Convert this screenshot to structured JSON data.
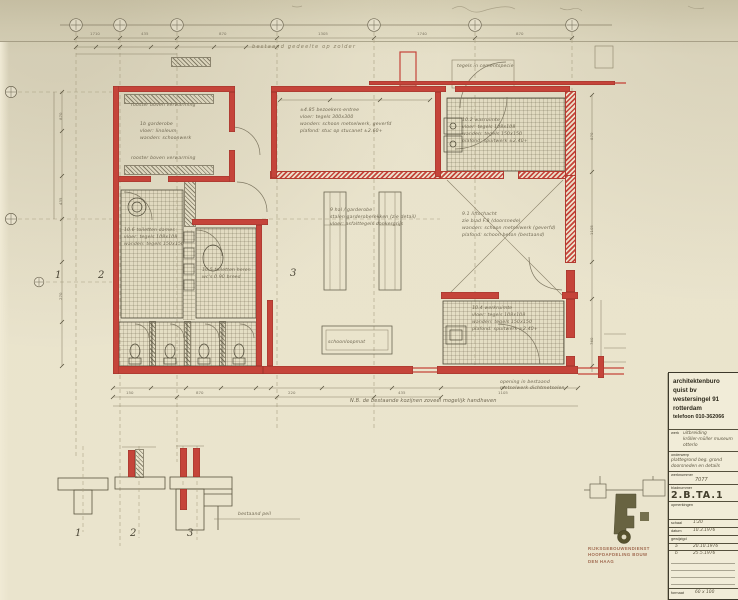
{
  "sheet": {
    "header_note": "bestaand gedeelte op zolder",
    "nb_note": "N.B.  de bestaande kozijnen zoveel mogelijk handhaven",
    "bestaand_peil": "bestaand peil",
    "vestibule_note": "tegels in cementspecie",
    "opening_note_1": "opening in bestaand",
    "opening_note_2": "metselwerk dichtmetselen",
    "section_markers": {
      "s1": "1",
      "s2": "2",
      "s3": "3"
    },
    "detail_labels": {
      "d1": "1",
      "d2": "2",
      "d3": "3"
    }
  },
  "rooms": {
    "garderobe": {
      "strip_top": "rooster boven verwarming",
      "l1": "1b  garderobe",
      "l2": "vloer: linoleum",
      "l3": "wanden: schoonwerk",
      "strip_bottom": "rooster boven verwarming"
    },
    "hal": {
      "l1": "±4.85  bezoekers-entree",
      "l2": "vloer: tegels 300x300",
      "l3": "wanden: schoon metselwerk, geverfd",
      "l4": "plafond: stuc op stucanet  ±2.60+"
    },
    "wasruimte": {
      "l1": "10.2  wasruimte",
      "l2": "vloer: tegels 108x108",
      "l3": "wanden: tegels 150x150",
      "l4": "plafond: spuitwerk  ±2.40+"
    },
    "lift": {
      "l1": "9.1  liftschacht",
      "l2": "zie blad F.8 (doorsnede)",
      "l3": "wanden: schoon metselwerk (geverfd)",
      "l4": "plafond: schoon beton (bestaand)"
    },
    "garderobe_rekken": {
      "l1": "9  hal / garderobe",
      "l2": "stalen garderoberekken (zie detail)",
      "l3": "vloer: asfalttegels donkergrijs"
    },
    "werkkast": {
      "l1": "10.4  werkruimte",
      "l2": "vloer: tegels 108x108",
      "l3": "wanden: tegels 150x150",
      "l4": "plafond: spuitwerk  ±2.40+"
    },
    "dames": {
      "l1": "10.6  toiletten dames",
      "l2": "vloer: tegels 108x108",
      "l3": "wanden: tegels 150x150"
    },
    "heren": {
      "l1": "10.5  toiletten heren",
      "l2": "wc's 0.90 breed"
    },
    "mat": "schoonloopmat"
  },
  "dims": {
    "top": {
      "t1": "1710",
      "t2": "435",
      "t3": "870",
      "t4": "1305",
      "t5": "1740",
      "t6": "870"
    },
    "left": {
      "v1": "870",
      "v2": "435",
      "v3": "270"
    },
    "right": {
      "r1": "870",
      "r2": "1105",
      "r3": "760"
    },
    "bottom": {
      "b1": "150",
      "b2": "870",
      "b3": "220",
      "b4": "435",
      "b5": "1105"
    }
  },
  "title_block": {
    "firm_l1": "architektenburo",
    "firm_l2": "quist bv",
    "firm_l3": "westersingel 91",
    "firm_l4": "rotterdam",
    "firm_l5": "telefoon 010-362066",
    "werk_label": "werk",
    "werk_1": "uitbreiding",
    "werk_2": "kröller-müller museum",
    "werk_3": "otterlo",
    "onderwerp_label": "onderwerp",
    "onderwerp_1": "plattegrond beg. grond",
    "onderwerp_2": "doorsneden en details",
    "werknummer_label": "werknummer",
    "werknummer": "7077",
    "bladnummer_label": "bladnummer",
    "bladnummer": "2.B.TA.1",
    "opmerkingen_label": "opmerkingen",
    "schaal_label": "schaal",
    "schaal": "1:20",
    "datum_label": "datum",
    "datum": "10.3.1976",
    "gewijzigd_label": "gewijzigd",
    "rev_a": "a",
    "rev_a_date": "20.10.1976",
    "rev_b": "b",
    "rev_b_date": "25.5.1976",
    "formaat_label": "formaat",
    "formaat": "60 x 100"
  },
  "stamp": {
    "l1": "RIJKSGEBOUWENDIENST",
    "l2": "HOOFDAFDELING BOUW",
    "l3": "DEN HAAG"
  }
}
